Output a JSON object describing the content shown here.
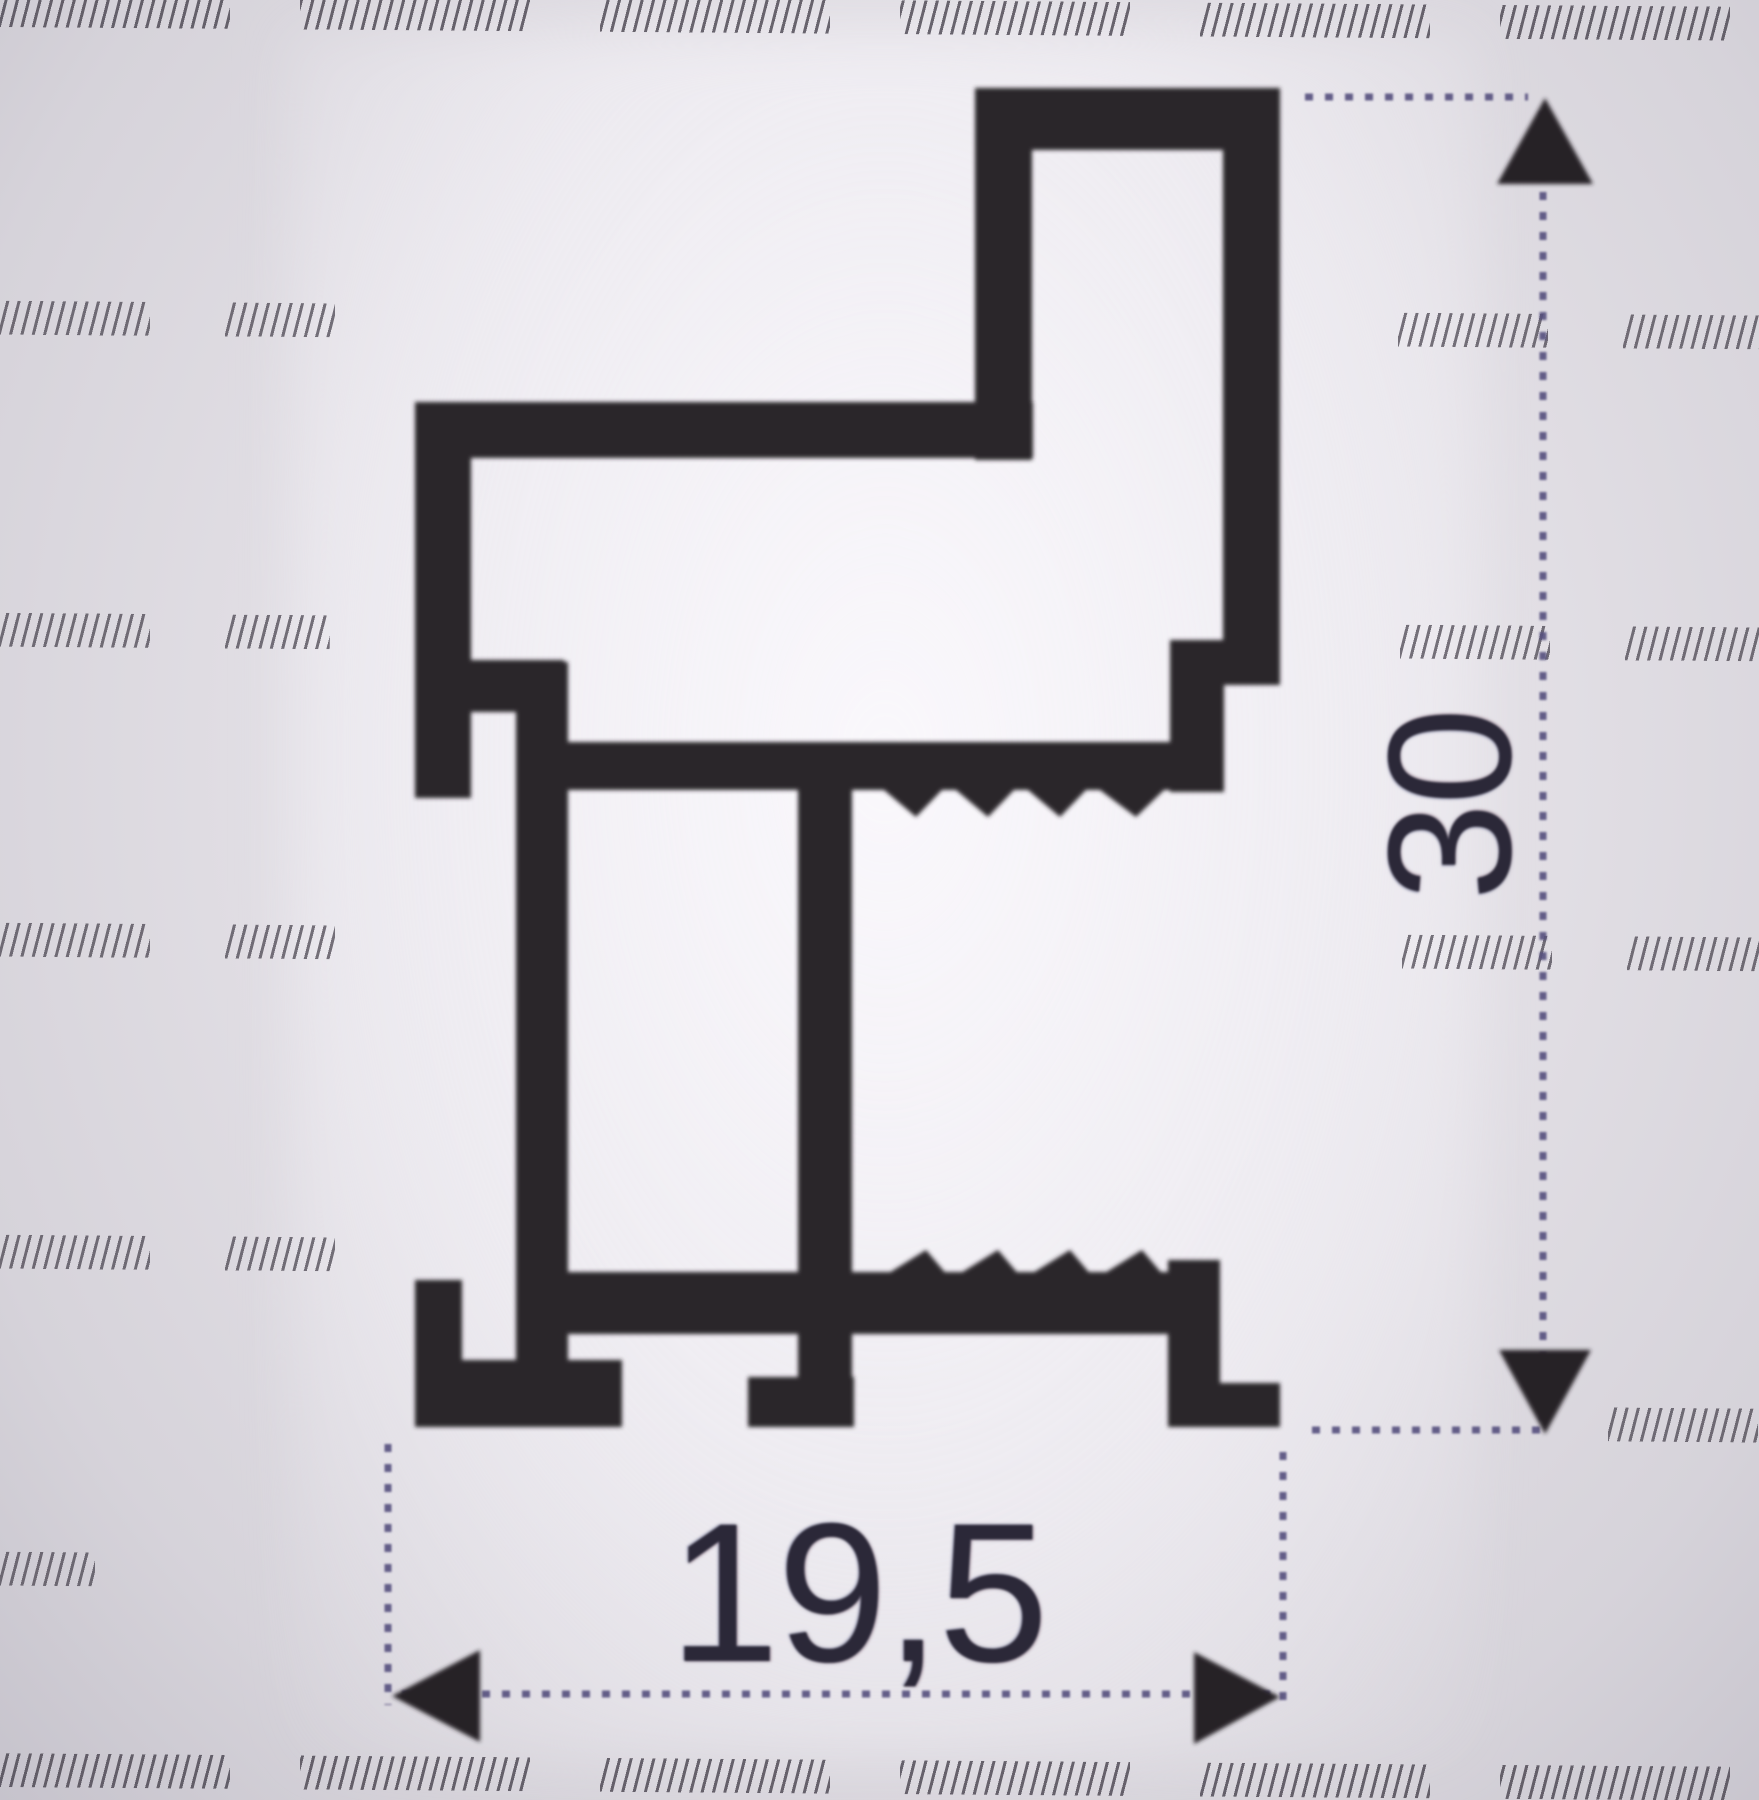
{
  "drawing": {
    "height_dimension": "30",
    "width_dimension": "19,5"
  },
  "colors": {
    "profile": "#2c272b",
    "arrow": "#272228",
    "dimension_line": "#554f7e",
    "label_text": "#2b2838",
    "hatch": "#474250"
  }
}
